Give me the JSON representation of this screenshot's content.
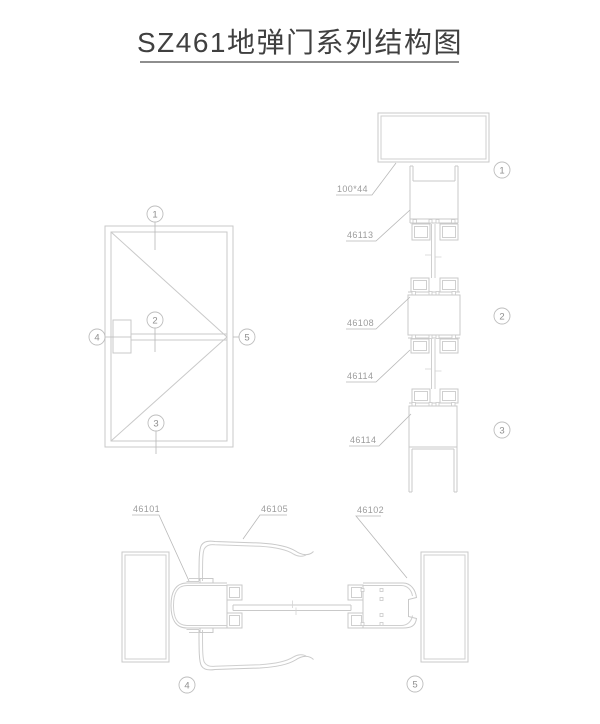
{
  "title": {
    "text": "SZ461地弹门系列结构图"
  },
  "colors": {
    "drawing_line": "#c9c9c9",
    "label_text": "#9c9c9c",
    "title_text": "#404040"
  },
  "elevation": {
    "callouts": [
      {
        "n": "1"
      },
      {
        "n": "2"
      },
      {
        "n": "3"
      },
      {
        "n": "4"
      },
      {
        "n": "5"
      }
    ]
  },
  "vertical_section": {
    "dimension_label": "100*44",
    "part_labels": [
      {
        "text": "46113"
      },
      {
        "text": "46108"
      },
      {
        "text": "46114"
      },
      {
        "text": "46114"
      }
    ],
    "callouts": [
      {
        "n": "1"
      },
      {
        "n": "2"
      },
      {
        "n": "3"
      }
    ]
  },
  "horizontal_section": {
    "part_labels": [
      {
        "text": "46101"
      },
      {
        "text": "46105"
      },
      {
        "text": "46102"
      }
    ],
    "callouts": [
      {
        "n": "4"
      },
      {
        "n": "5"
      }
    ]
  }
}
